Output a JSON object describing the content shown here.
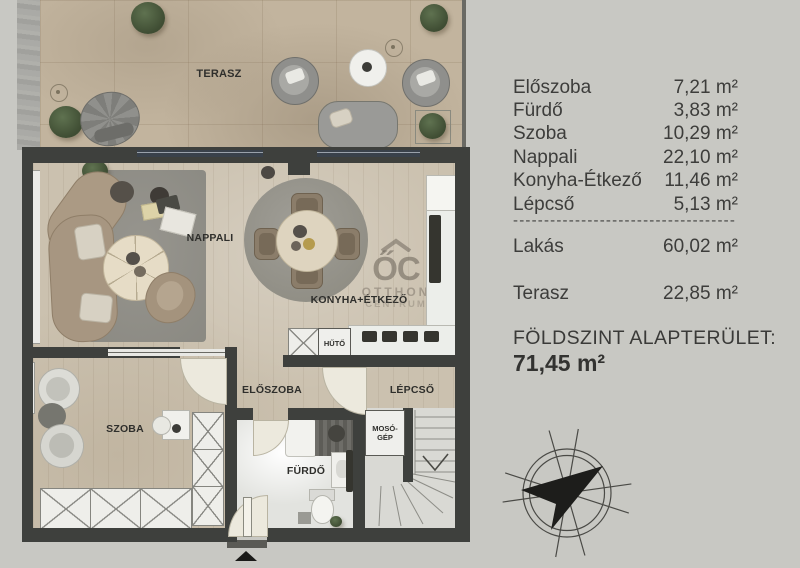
{
  "panel": {
    "rows": [
      {
        "label": "Előszoba",
        "value": "7,21 m²"
      },
      {
        "label": "Fürdő",
        "value": "3,83 m²"
      },
      {
        "label": "Szoba",
        "value": "10,29 m²"
      },
      {
        "label": "Nappali",
        "value": "22,10 m²"
      },
      {
        "label": "Konyha-Étkező",
        "value": "11,46 m²"
      },
      {
        "label": "Lépcső",
        "value": "5,13 m²"
      }
    ],
    "separator": "------------------------------------",
    "totals": [
      {
        "label": "Lakás",
        "value": "60,02 m²"
      },
      {
        "label": "Terasz",
        "value": "22,85 m²"
      }
    ],
    "footer_title": "FÖLDSZINT ALAPTERÜLET:",
    "footer_value": "71,45 m²"
  },
  "plan": {
    "labels": {
      "terasz": "TERASZ",
      "nappali": "NAPPALI",
      "konyha": "KONYHA+ÉTKEZŐ",
      "eloszoba": "ELŐSZOBA",
      "szoba": "SZOBA",
      "furdo": "FÜRDŐ",
      "lepcso": "LÉPCSŐ",
      "huto": "HŰTŐ",
      "mosogep": "MOSÓ-GÉP"
    },
    "watermark": {
      "logo": "ŐC",
      "line1": "OTTHON",
      "line2": "CENTRUM"
    }
  },
  "colors": {
    "background": "#c8c8c3",
    "wall": "#3e403d",
    "wood": "#cbc1af",
    "terrace": "#c2b49e",
    "needle": "#1d1d1b"
  }
}
